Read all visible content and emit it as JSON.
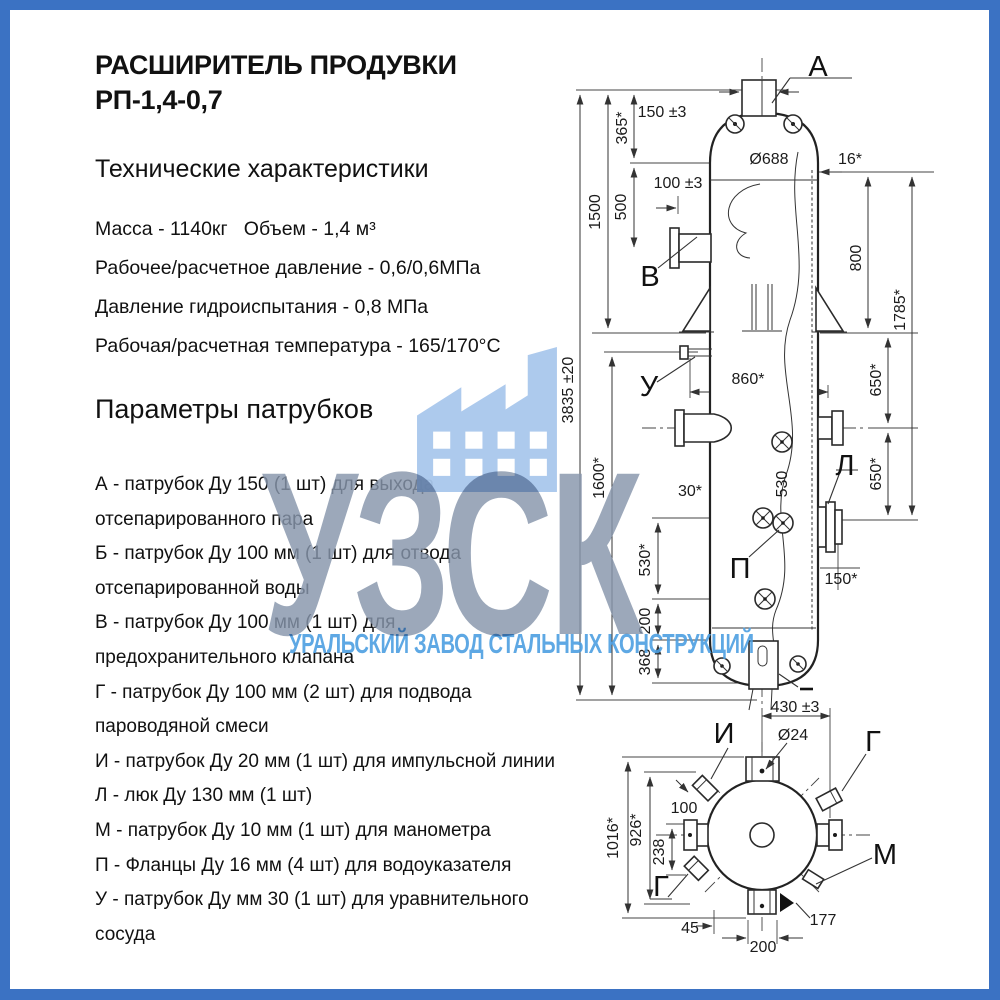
{
  "page": {
    "border_color": "#3b72c3",
    "background": "#ffffff"
  },
  "left_panel": {
    "title_line1": "РАСШИРИТЕЛЬ ПРОДУВКИ",
    "title_line2": "РП-1,4-0,7",
    "specs_heading": "Технические характеристики",
    "specs": [
      "Масса - 1140кг   Объем - 1,4 м³",
      "Рабочее/расчетное давление - 0,6/0,6МПа",
      "Давление гидроиспытания - 0,8 МПа",
      "Рабочая/расчетная температура - 165/170°С"
    ],
    "nozzles_heading": "Параметры патрубков",
    "nozzle_lines": [
      "А - патрубок Ду 150 (1 шт) для выхода",
      "отсепарированного пара",
      "Б - патрубок Ду 100 мм (1 шт) для отвода",
      "отсепарированной воды",
      "В - патрубок Ду 100 мм (1 шт) для",
      "предохранительного клапана",
      "Г - патрубок Ду 100 мм (2 шт) для подвода",
      "пароводяной смеси",
      "И - патрубок Ду 20 мм (1 шт) для импульсной линии",
      "Л - люк Ду 130 мм (1 шт)",
      "М - патрубок Ду 10 мм (1 шт) для манометра",
      "П - Фланцы Ду 16 мм (4 шт) для водоуказателя",
      "У - патрубок Ду мм 30 (1 шт) для уравнительного",
      "сосуда"
    ]
  },
  "watermark": {
    "letters": "УЗСК",
    "subtitle": "УРАЛЬСКИЙ ЗАВОД СТАЛЬНЫХ КОНСТРУКЦИЙ",
    "icon": "factory-icon",
    "icon_color": "#a9c7ec",
    "letters_color": "#8695ab",
    "subtitle_color": "#4c9fe1"
  },
  "drawing": {
    "dim_labels": [
      {
        "t": "150 ±3",
        "x": 662,
        "y": 117
      },
      {
        "t": "365*",
        "x": 627,
        "y": 128,
        "r": -90
      },
      {
        "t": "1500",
        "x": 600,
        "y": 212,
        "r": -90
      },
      {
        "t": "3835 ±20",
        "x": 573,
        "y": 390,
        "r": -90
      },
      {
        "t": "500",
        "x": 626,
        "y": 207,
        "r": -90
      },
      {
        "t": "100 ±3",
        "x": 678,
        "y": 188
      },
      {
        "t": "Ø688",
        "x": 769,
        "y": 164
      },
      {
        "t": "16*",
        "x": 850,
        "y": 164
      },
      {
        "t": "800",
        "x": 861,
        "y": 258,
        "r": -90
      },
      {
        "t": "1785*",
        "x": 905,
        "y": 310,
        "r": -90
      },
      {
        "t": "650*",
        "x": 881,
        "y": 380,
        "r": -90
      },
      {
        "t": "650*",
        "x": 881,
        "y": 474,
        "r": -90
      },
      {
        "t": "860*",
        "x": 748,
        "y": 384
      },
      {
        "t": "1600*",
        "x": 604,
        "y": 478,
        "r": -90
      },
      {
        "t": "30*",
        "x": 690,
        "y": 496
      },
      {
        "t": "530",
        "x": 787,
        "y": 484,
        "r": -90
      },
      {
        "t": "530*",
        "x": 650,
        "y": 560,
        "r": -90
      },
      {
        "t": "150*",
        "x": 841,
        "y": 584
      },
      {
        "t": "200",
        "x": 650,
        "y": 621,
        "r": -90
      },
      {
        "t": "368",
        "x": 650,
        "y": 662,
        "r": -90
      },
      {
        "t": "430 ±3",
        "x": 795,
        "y": 712
      },
      {
        "t": "Ø24",
        "x": 793,
        "y": 740
      },
      {
        "t": "1016*",
        "x": 618,
        "y": 838,
        "r": -90
      },
      {
        "t": "926*",
        "x": 641,
        "y": 830,
        "r": -90
      },
      {
        "t": "238",
        "x": 664,
        "y": 852,
        "r": -90
      },
      {
        "t": "100",
        "x": 684,
        "y": 813
      },
      {
        "t": "45",
        "x": 690,
        "y": 933
      },
      {
        "t": "200",
        "x": 763,
        "y": 952
      },
      {
        "t": "177",
        "x": 823,
        "y": 925
      }
    ],
    "callouts": [
      {
        "t": "А",
        "x": 818,
        "y": 76
      },
      {
        "t": "В",
        "x": 650,
        "y": 286
      },
      {
        "t": "У",
        "x": 649,
        "y": 396
      },
      {
        "t": "Л",
        "x": 845,
        "y": 475
      },
      {
        "t": "П",
        "x": 740,
        "y": 578
      },
      {
        "t": "И",
        "x": 724,
        "y": 743
      },
      {
        "t": "Г",
        "x": 873,
        "y": 751
      },
      {
        "t": "М",
        "x": 885,
        "y": 864
      },
      {
        "t": "Г",
        "x": 661,
        "y": 896
      }
    ]
  }
}
